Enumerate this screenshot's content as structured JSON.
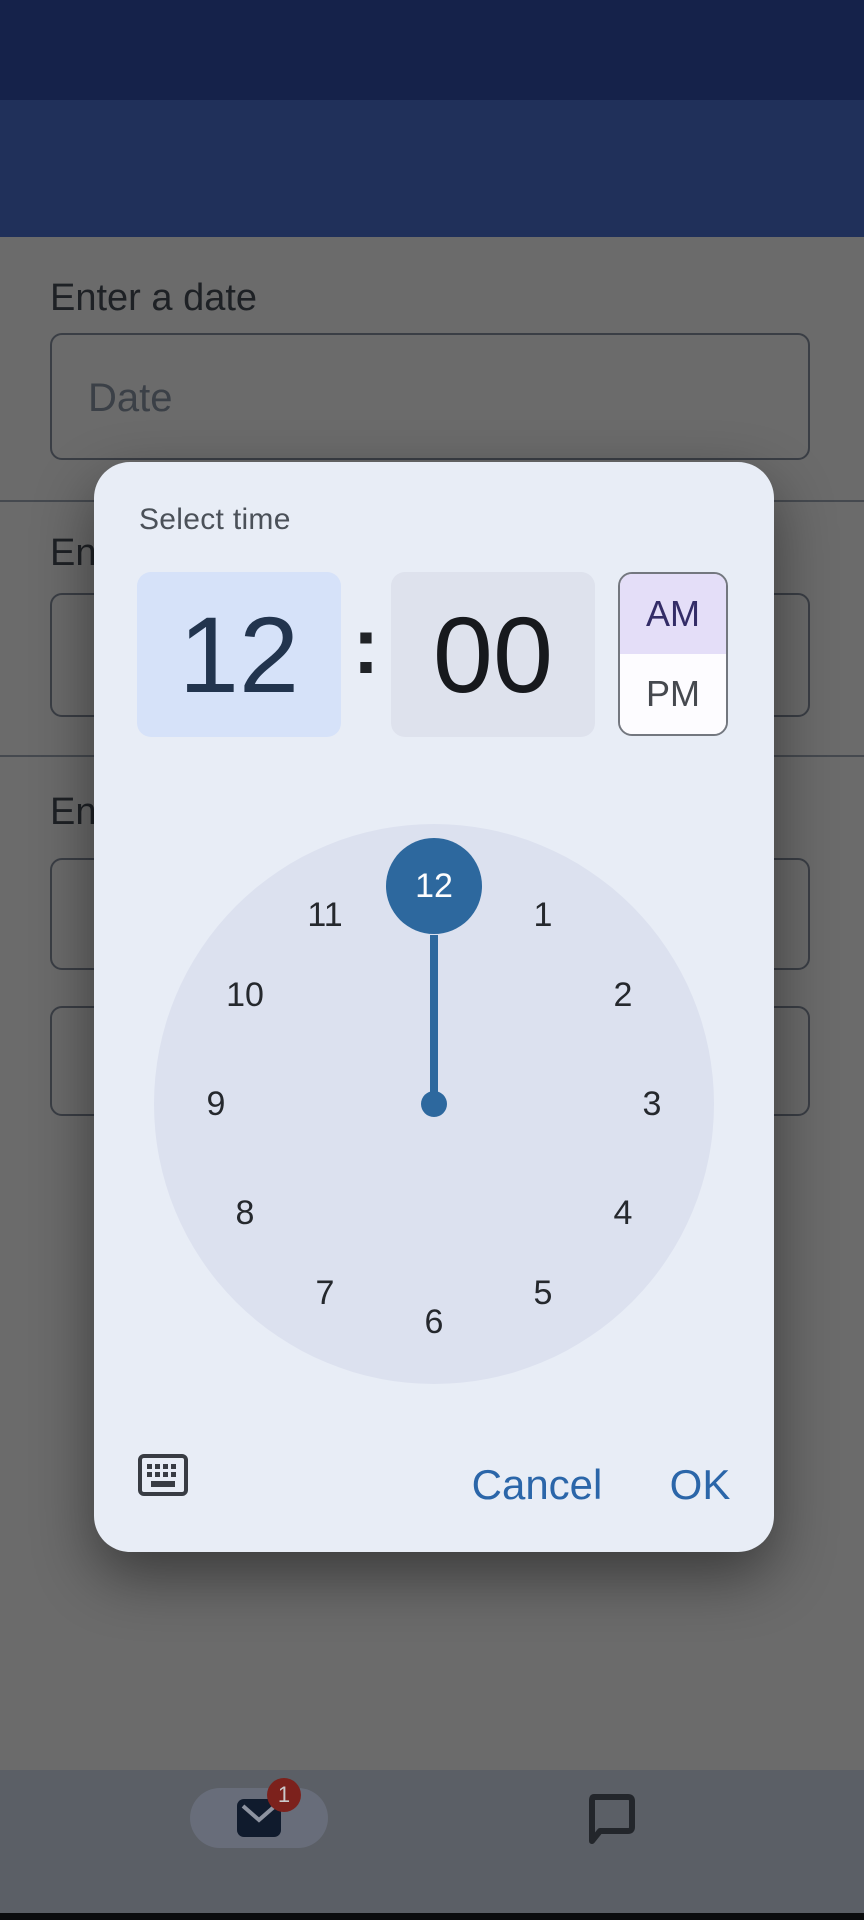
{
  "app_bar": {
    "title": "Contacts"
  },
  "form": {
    "date_label": "Enter a date",
    "date_placeholder": "Date",
    "partial_label_2": "En",
    "partial_label_3": "En"
  },
  "dialog": {
    "title": "Select time",
    "hour": "12",
    "colon": ":",
    "minute": "00",
    "am_label": "AM",
    "pm_label": "PM",
    "selected_hour": "12",
    "cancel_label": "Cancel",
    "ok_label": "OK",
    "selected_period": "AM"
  },
  "clock": {
    "numbers": [
      "12",
      "1",
      "2",
      "3",
      "4",
      "5",
      "6",
      "7",
      "8",
      "9",
      "10",
      "11"
    ]
  },
  "bottom_nav": {
    "mail_badge_count": "1"
  },
  "icons": [
    "close-icon",
    "more-vert-icon",
    "keyboard-icon",
    "mail-icon",
    "chat-icon"
  ],
  "colors": {
    "app_bar_bg": "#20305a",
    "status_bar_bg": "#15224a",
    "dialog_surface": "#e8edf6",
    "clock_face": "#dce1ef",
    "selection_blue": "#2d689e",
    "hour_cell_bg": "#d6e2f9",
    "minute_cell_bg": "#dee2ed",
    "am_bg": "#e4def8",
    "action_blue": "#2b66a9",
    "badge_red": "#7c211c"
  }
}
